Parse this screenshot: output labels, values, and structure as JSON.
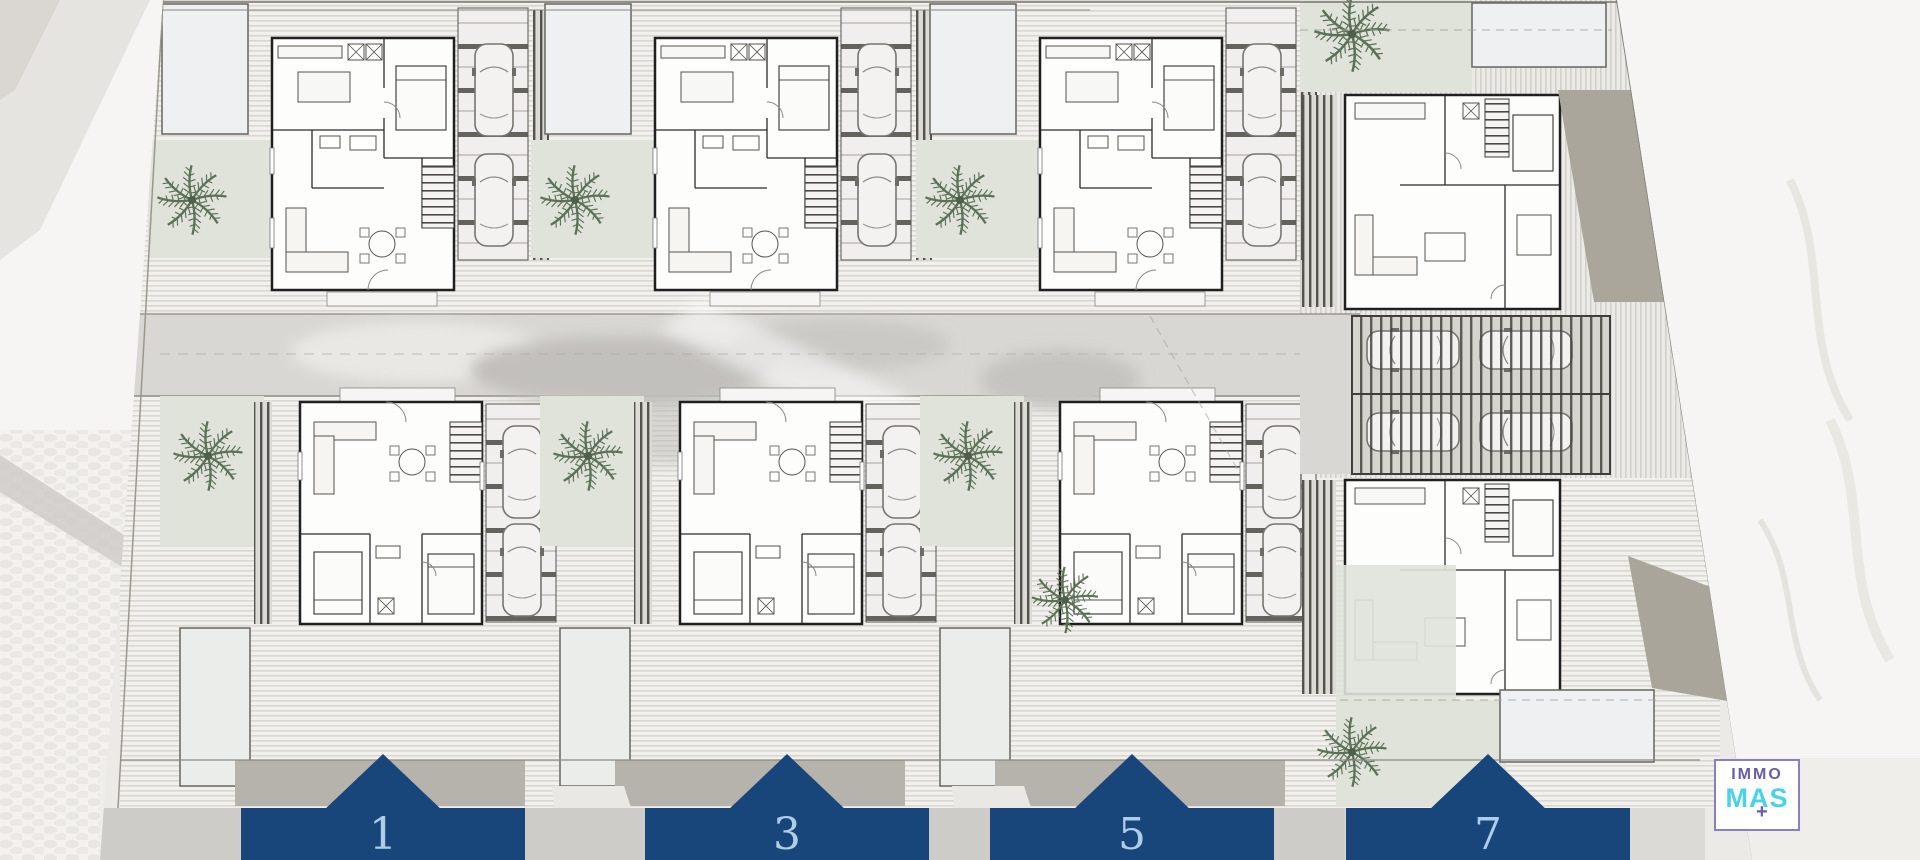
{
  "plan": {
    "kind": "residential site / floor plan",
    "unit_labels": [
      "1",
      "3",
      "5",
      "7"
    ],
    "standard_villa_count": 6,
    "corner_villa_count": 2,
    "cars_per_driveway": 2,
    "pergola_car_count": 4,
    "palm_count": 9,
    "pools_visible": 8
  },
  "banners": [
    {
      "label": "1"
    },
    {
      "label": "3"
    },
    {
      "label": "5"
    },
    {
      "label": "7"
    }
  ],
  "logo": {
    "top": "IMMO",
    "bottom": "MAS",
    "plus": "+"
  },
  "colors": {
    "banner_navy": "#19467a",
    "banner_number_blue": "#aecde9",
    "logo_purple": "#6a5da5",
    "logo_cyan": "#49d2e8",
    "lawn_green": "#dfe3da",
    "road_gray": "#d8d7d3",
    "deck_light": "#f1f0ec",
    "deck_line": "#d9d7d1",
    "wall_dark": "#202020",
    "boundary_wedge_tan": "#aaa69c",
    "pool_fill": "#eef0f2",
    "background": "#f6f5f3"
  },
  "icons": [
    {
      "name": "palm-tree-icon"
    },
    {
      "name": "car-icon"
    }
  ]
}
